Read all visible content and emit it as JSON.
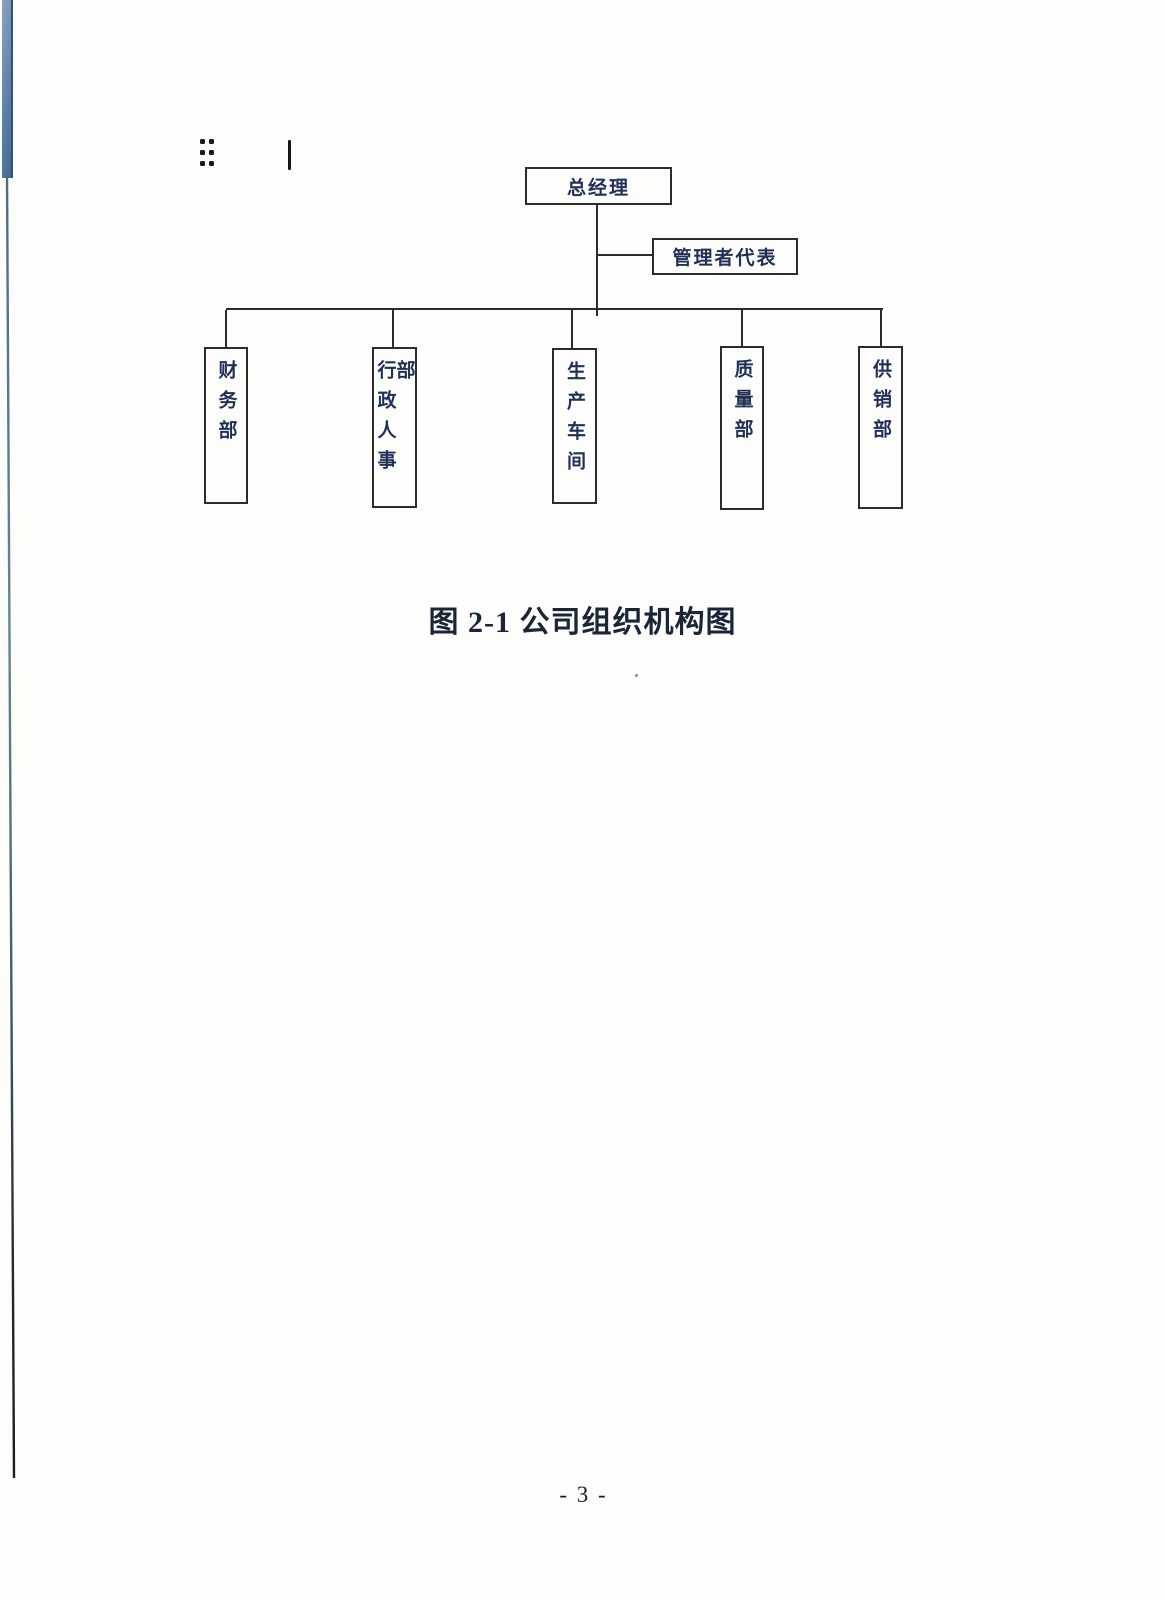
{
  "page": {
    "caption": "图 2-1 公司组织机构图",
    "page_number": "- 3 -"
  },
  "org_chart": {
    "type": "organization-chart",
    "root": {
      "label": "总经理"
    },
    "management_rep": {
      "label": "管理者代表"
    },
    "departments": [
      {
        "label": "财务部"
      },
      {
        "label": "行政人事部"
      },
      {
        "label": "生产车间"
      },
      {
        "label": "质量部"
      },
      {
        "label": "供销部"
      }
    ]
  },
  "colors": {
    "line": "#2c2c2c",
    "box_text": "#223055",
    "caption_text": "#1c2538",
    "scan_band_blue": "#5e81a9",
    "paper": "#fdfdfc"
  }
}
